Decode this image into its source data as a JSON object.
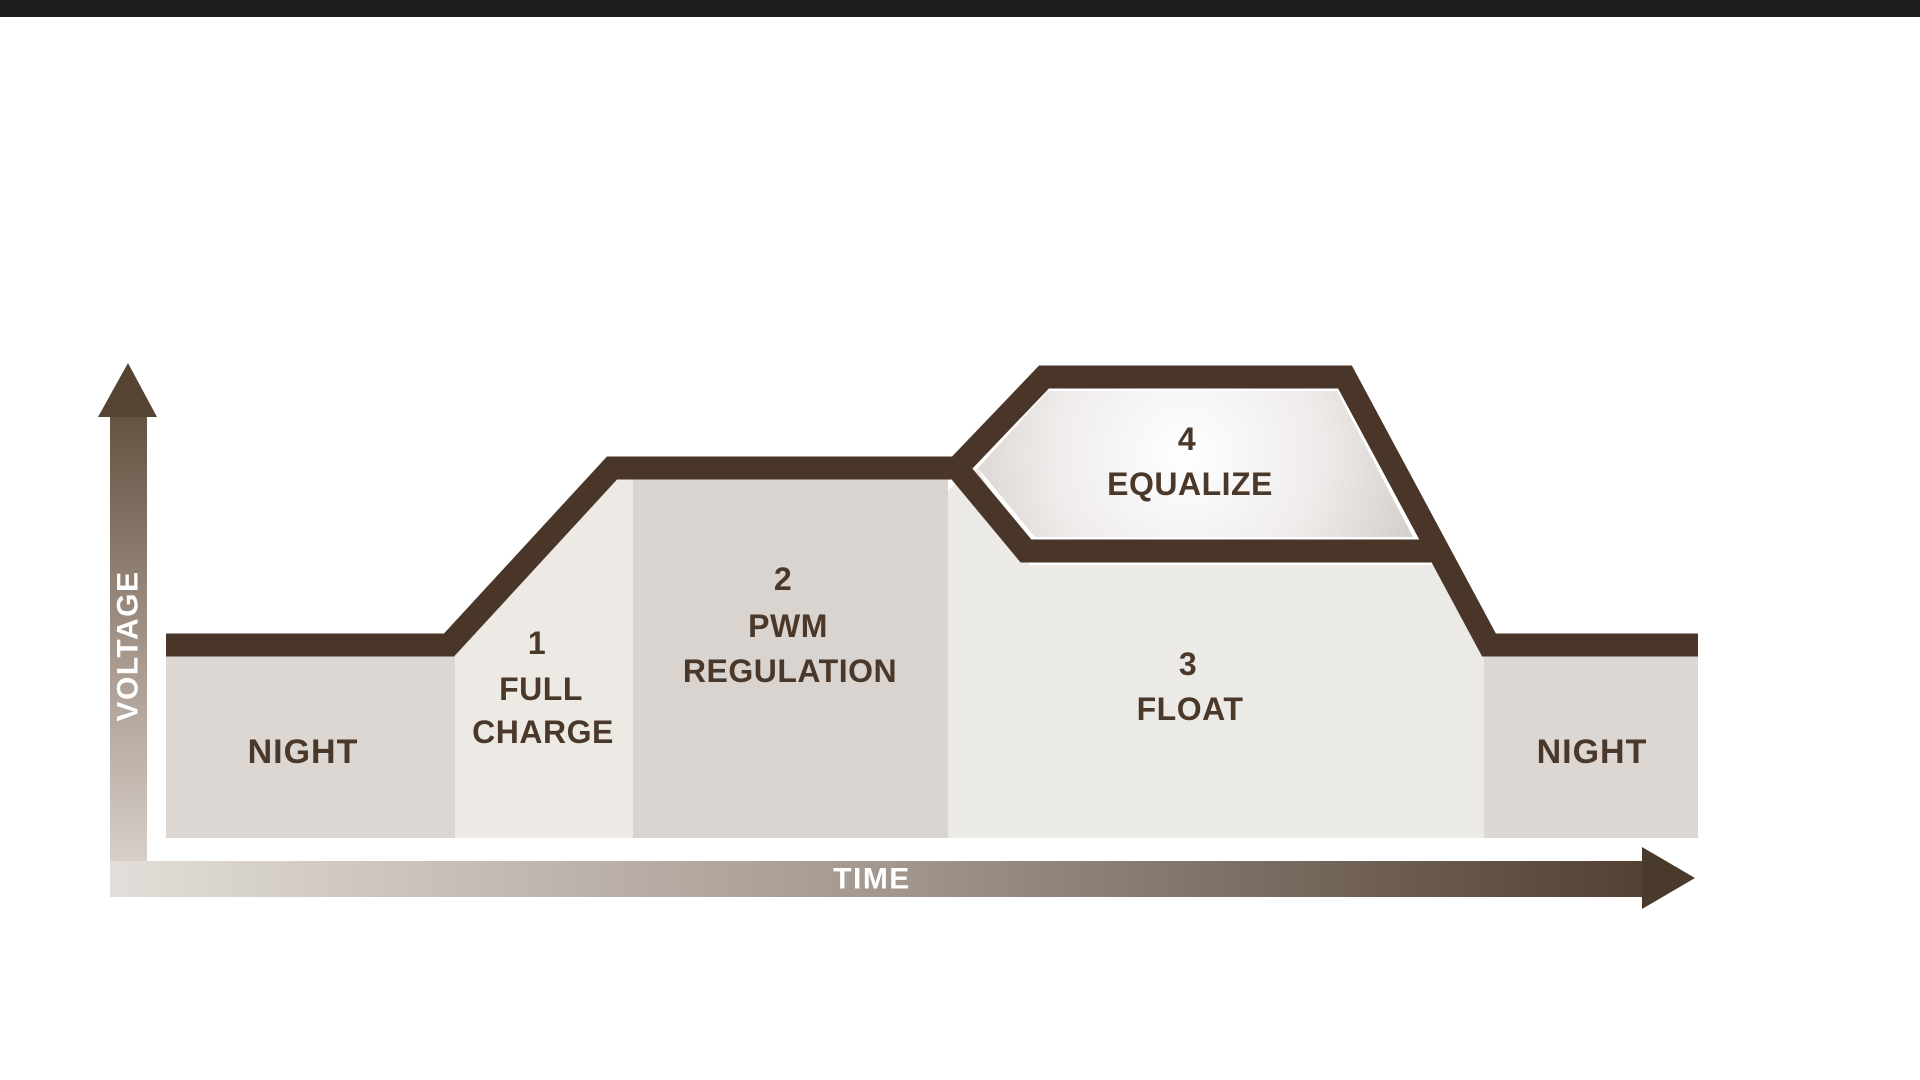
{
  "diagram": {
    "description": "Solar charge controller battery charging stages: voltage vs time profile",
    "y_axis": {
      "label": "VOLTAGE"
    },
    "x_axis": {
      "label": "TIME"
    },
    "periods": {
      "night_left": "NIGHT",
      "night_right": "NIGHT"
    },
    "stages": {
      "stage1": {
        "number": "1",
        "line1": "FULL",
        "line2": "CHARGE"
      },
      "stage2": {
        "number": "2",
        "line1": "PWM",
        "line2": "REGULATION"
      },
      "stage3": {
        "number": "3",
        "line1": "FLOAT"
      },
      "stage4": {
        "number": "4",
        "line1": "EQUALIZE"
      }
    },
    "sequence_note": "voltage: night low, rises during full charge, holds at PWM regulation, equalize peak sits above float level, returns to night low",
    "colors": {
      "top_bar": "#1d1d1d",
      "outline": "#4a3628",
      "label_text": "#4a382a",
      "axis_text": "#ffffff",
      "night_fill": "#dcd7d2",
      "full_charge_fill": "#edeae5",
      "pwm_fill": "#d9d4cf",
      "float_fill": "#eceae6",
      "equalize_center": "#ffffff",
      "equalize_edge": "#d5cfca",
      "axis_gradient_light": "#e3ded9",
      "axis_gradient_dark": "#4c3b2d"
    }
  }
}
